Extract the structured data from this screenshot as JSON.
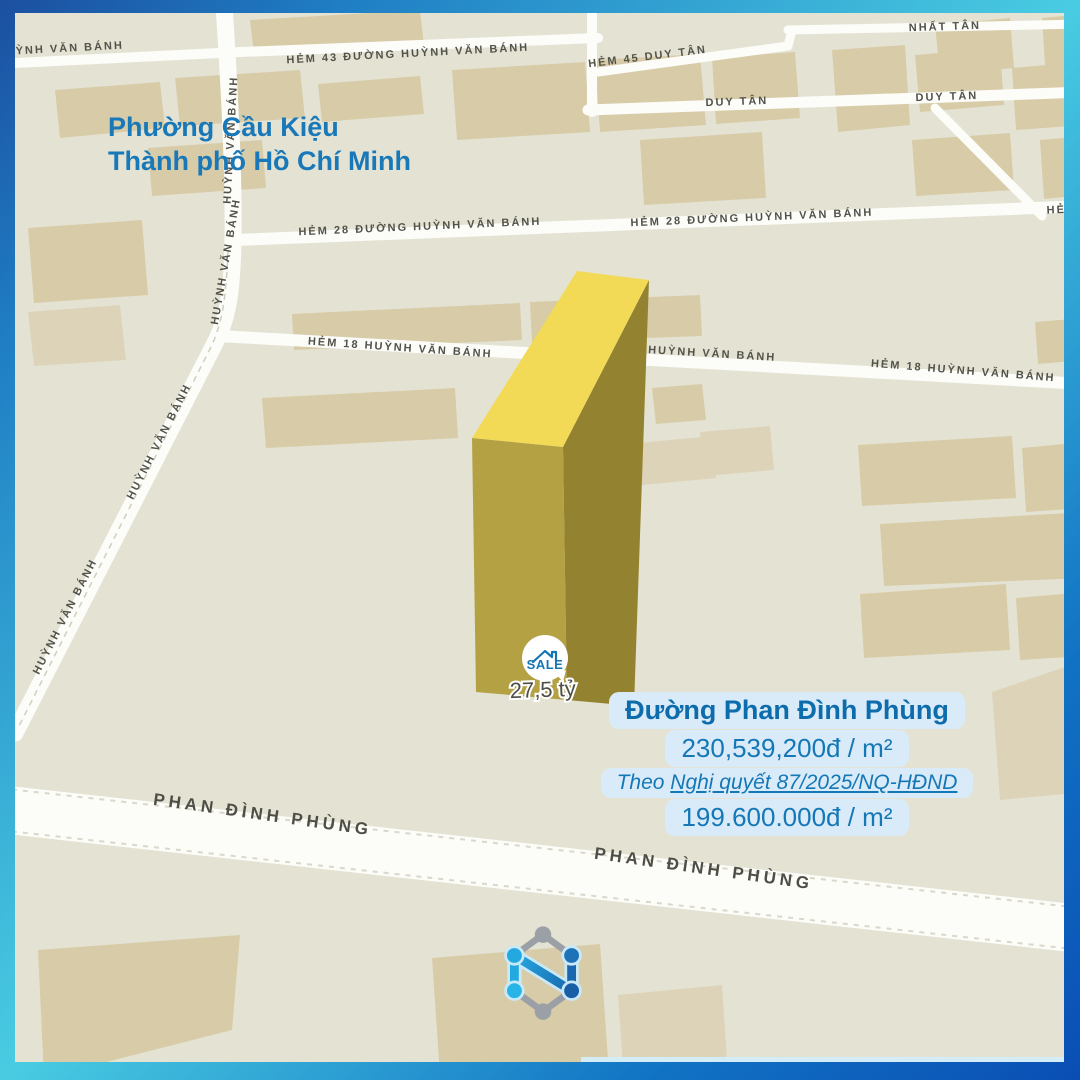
{
  "header": {
    "ward": "Phường Cầu Kiệu",
    "city": "Thành phố Hồ Chí Minh"
  },
  "map": {
    "street_labels": [
      {
        "text": "HUỲNH VĂN BÁNH"
      },
      {
        "text": "HẺM 43 ĐƯỜNG HUỲNH VĂN BÁNH"
      },
      {
        "text": "HẺM 45 DUY TÂN"
      },
      {
        "text": "NHẤT TÂN"
      },
      {
        "text": "DUY TÂN"
      },
      {
        "text": "DUY TÂN"
      },
      {
        "text": "HẺM 28 ĐƯỜNG HUỲNH VĂN BÁNH"
      },
      {
        "text": "HẺM 28 ĐƯỜNG HUỲNH VĂN BÁNH"
      },
      {
        "text": "HẺM"
      },
      {
        "text": "HUỲNH VĂN BÁNH"
      },
      {
        "text": "HUỲNH VĂN BÁNH"
      },
      {
        "text": "HUỲNH VĂN BÁNH"
      },
      {
        "text": "HUỲNH VĂN BÁNH"
      },
      {
        "text": "HẺM 18 HUỲNH VĂN BÁNH"
      },
      {
        "text": "HUỲNH VĂN BÁNH"
      },
      {
        "text": "HẺM 18 HUỲNH VĂN BÁNH"
      },
      {
        "text": "PHAN ĐÌNH PHÙNG"
      },
      {
        "text": "PHAN ĐÌNH PHÙNG"
      }
    ]
  },
  "marker": {
    "badge": "SALE",
    "price": "27,5 tỷ"
  },
  "info_box": {
    "street": "Đường Phan Đình Phùng",
    "new_price": "230,539,200đ / m²",
    "note_prefix": "Theo ",
    "note_link": "Nghị quyết 87/2025/NQ-HĐND",
    "old_price": "199.600.000đ / m²"
  },
  "colors": {
    "accent_blue": "#1878b8",
    "info_bg": "#d9eaf8",
    "parcel_top": "#f2da57",
    "parcel_front": "#b3a144",
    "parcel_side": "#93822f",
    "map_bg": "#e4e3d3",
    "building": "#d8cba8",
    "frame_navy": "#1c4fa0",
    "frame_cyan": "#49cce2",
    "frame_blue": "#0a4eb4"
  }
}
